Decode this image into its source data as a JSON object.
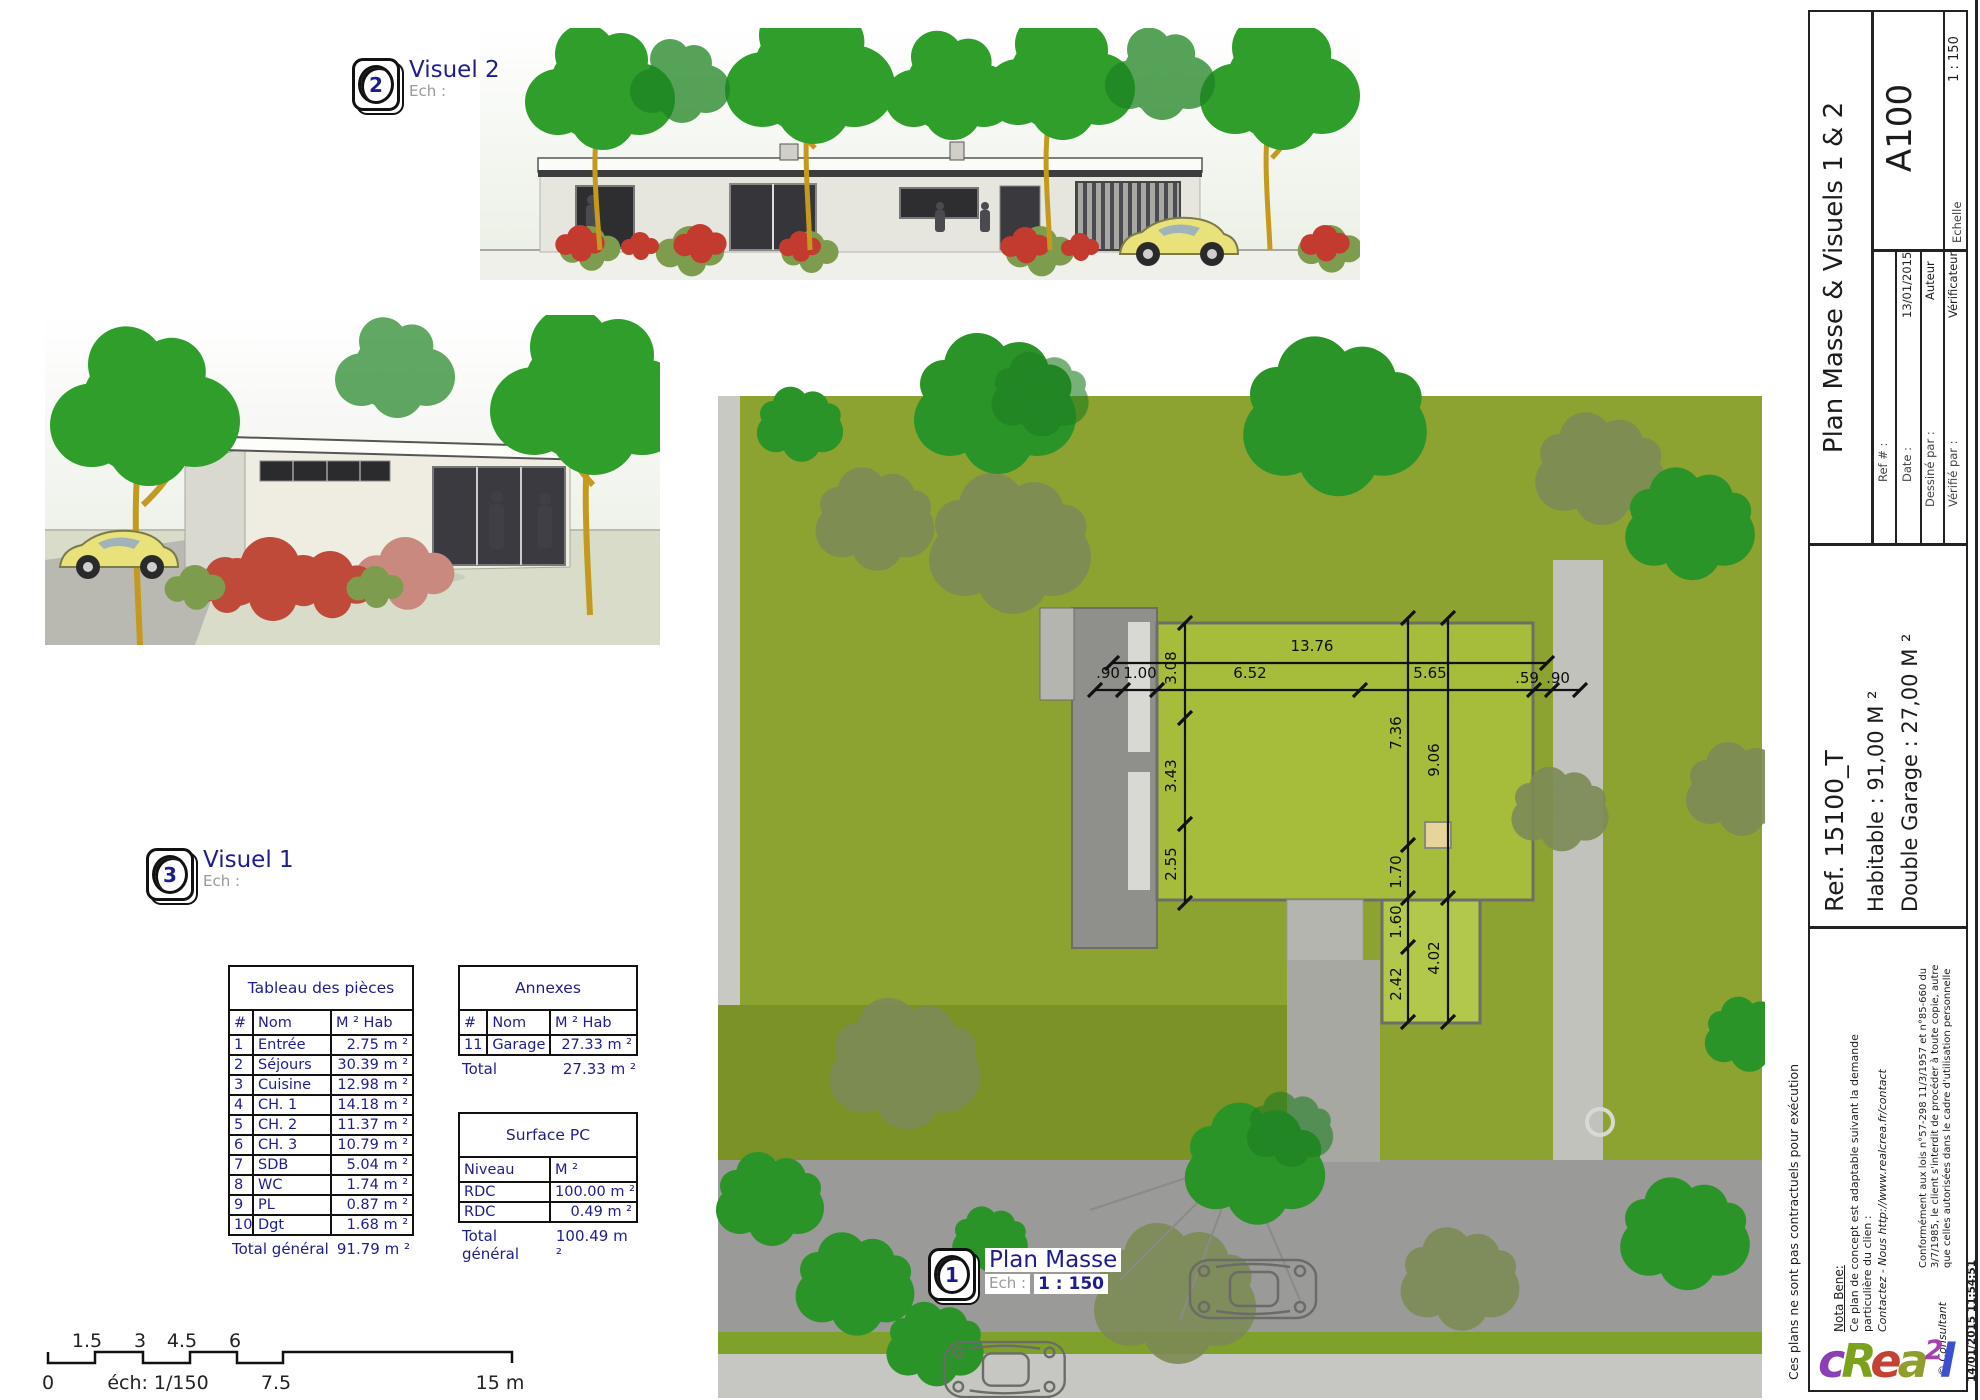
{
  "callouts": {
    "visuel2": {
      "number": "2",
      "title": "Visuel 2",
      "scale_label": "Ech :",
      "scale_value": ""
    },
    "visuel1": {
      "number": "3",
      "title": "Visuel 1",
      "scale_label": "Ech :",
      "scale_value": ""
    },
    "plan_masse": {
      "number": "1",
      "title": "Plan Masse",
      "scale_label": "Ech :",
      "scale_value": "1 : 150"
    }
  },
  "tables": {
    "pieces": {
      "title": "Tableau des pièces",
      "headers": [
        "#",
        "Nom",
        "M ² Hab"
      ],
      "col_widths": [
        24,
        78,
        82
      ],
      "rows": [
        [
          "1",
          "Entrée",
          "2.75 m ²"
        ],
        [
          "2",
          "Séjours",
          "30.39 m ²"
        ],
        [
          "3",
          "Cuisine",
          "12.98 m ²"
        ],
        [
          "4",
          "CH. 1",
          "14.18 m ²"
        ],
        [
          "5",
          "CH. 2",
          "11.37 m ²"
        ],
        [
          "6",
          "CH. 3",
          "10.79 m ²"
        ],
        [
          "7",
          "SDB",
          "5.04 m ²"
        ],
        [
          "8",
          "WC",
          "1.74 m ²"
        ],
        [
          "9",
          "PL",
          "0.87 m ²"
        ],
        [
          "10",
          "Dgt",
          "1.68 m ²"
        ]
      ],
      "total_label": "Total général",
      "total_value": "91.79 m ²"
    },
    "annexes": {
      "title": "Annexes",
      "headers": [
        "#",
        "Nom",
        "M ² Hab"
      ],
      "col_widths": [
        28,
        62,
        86
      ],
      "rows": [
        [
          "11",
          "Garage",
          "27.33 m ²"
        ]
      ],
      "total_label": "Total",
      "total_value": "27.33 m ²"
    },
    "surface_pc": {
      "title": "Surface PC",
      "headers": [
        "Niveau",
        "M ²"
      ],
      "col_widths": [
        90,
        86
      ],
      "rows": [
        [
          "RDC",
          "100.00 m ²"
        ],
        [
          "RDC",
          "0.49 m ²"
        ]
      ],
      "total_label": "Total général",
      "total_value": "100.49 m ²"
    }
  },
  "scale_bar": {
    "top_labels": [
      {
        "t": "1.5",
        "x": 87
      },
      {
        "t": "3",
        "x": 140
      },
      {
        "t": "4.5",
        "x": 182
      },
      {
        "t": "6",
        "x": 235
      }
    ],
    "bottom_labels": [
      {
        "t": "0",
        "x": 48
      },
      {
        "t": "éch: 1/150",
        "x": 158
      },
      {
        "t": "7.5",
        "x": 276
      },
      {
        "t": "15 m",
        "x": 500
      }
    ]
  },
  "plan": {
    "dimensions": [
      {
        "text": "13.76",
        "x": 1312,
        "y": 646,
        "rot": 0
      },
      {
        "text": ".90",
        "x": 1108,
        "y": 673,
        "rot": 0
      },
      {
        "text": "1.00",
        "x": 1140,
        "y": 673,
        "rot": 0
      },
      {
        "text": "6.52",
        "x": 1250,
        "y": 673,
        "rot": 0
      },
      {
        "text": "5.65",
        "x": 1430,
        "y": 673,
        "rot": 0
      },
      {
        "text": ".59",
        "x": 1527,
        "y": 678,
        "rot": 0
      },
      {
        "text": ".90",
        "x": 1558,
        "y": 678,
        "rot": 0
      },
      {
        "text": "3.08",
        "x": 1171,
        "y": 668,
        "rot": -90
      },
      {
        "text": "3.43",
        "x": 1171,
        "y": 776,
        "rot": -90
      },
      {
        "text": "2.55",
        "x": 1171,
        "y": 864,
        "rot": -90
      },
      {
        "text": "7.36",
        "x": 1396,
        "y": 733,
        "rot": -90
      },
      {
        "text": "9.06",
        "x": 1434,
        "y": 760,
        "rot": -90
      },
      {
        "text": "1.70",
        "x": 1396,
        "y": 872,
        "rot": -90
      },
      {
        "text": "1.60",
        "x": 1396,
        "y": 922,
        "rot": -90
      },
      {
        "text": "2.42",
        "x": 1396,
        "y": 984,
        "rot": -90
      },
      {
        "text": "4.02",
        "x": 1434,
        "y": 958,
        "rot": -90
      }
    ]
  },
  "title_block": {
    "title": "Plan Masse & Visuels 1 & 2",
    "sheet_number": "A100",
    "fields": {
      "ref_label": "Ref # :",
      "ref_value": "",
      "date_label": "Date :",
      "date_value": "13/01/2015",
      "drawn_label": "Dessiné par :",
      "drawn_value": "Auteur",
      "checked_label": "Vérifié par :",
      "checked_value": "Vérificateur",
      "scale_label": "Echelle",
      "scale_value": "1 : 150"
    },
    "project_ref": "Ref. 15100_T",
    "area_line1": "Habitable : 91,00 M ²",
    "area_line2": "Double Garage : 27,00 M ²",
    "nota_bene_title": "Nota Bene:",
    "nota_bene_line1": "Ce plan de concept est adaptable suivant la demande",
    "nota_bene_line2": "particulière du clien :",
    "nota_bene_line3": "Contactez - Nous http://www.realcrea.fr/contact",
    "legal_line1": "Conformément aux lois n°57-298 11/3/1957 et n°85-660 du",
    "legal_line2": "3/7/1985, le client s'interdit de procéder à toute copie, autre",
    "legal_line3": "que celles autorisées dans le cadre d'utilisation personnelle",
    "copyright": "© Consultant",
    "timestamp": "14/01/2015 11:54:51",
    "disclaimer": "Ces plans ne sont pas contractuels pour exécution",
    "logo_letters": [
      {
        "ch": "c",
        "color": "#8b3fb5",
        "sup": false
      },
      {
        "ch": "R",
        "color": "#7aa21d",
        "sup": false
      },
      {
        "ch": "e",
        "color": "#c44232",
        "sup": false
      },
      {
        "ch": "a",
        "color": "#8f9e2d",
        "sup": false
      },
      {
        "ch": "2",
        "color": "#a83fae",
        "sup": true
      },
      {
        "ch": "l",
        "color": "#3b4fd0",
        "sup": false
      }
    ]
  },
  "colors": {
    "accent_navy": "#1d1d8f",
    "lawn": "#8da331",
    "roof": "#a6bd3c",
    "road": "#9a9a98"
  }
}
